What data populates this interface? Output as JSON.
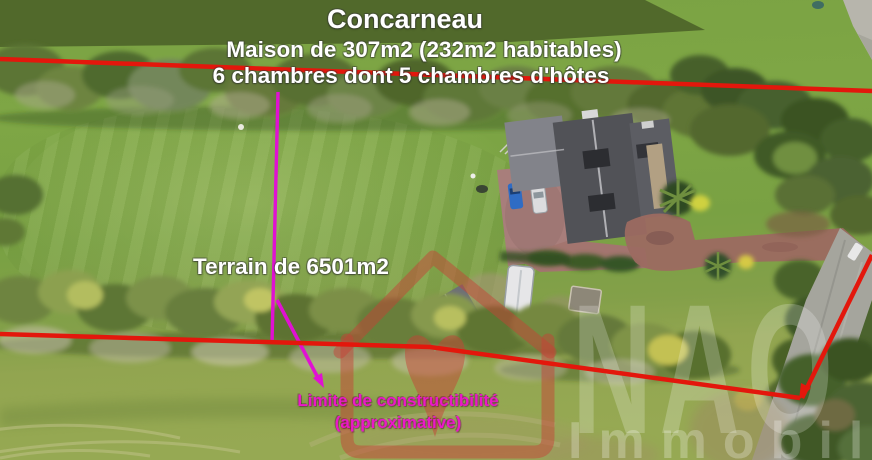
{
  "location": {
    "title": "Concarneau"
  },
  "property": {
    "line1": "Maison de 307m2 (232m2 habitables)",
    "line2": "6 chambres dont 5 chambres d'hôtes"
  },
  "terrain": {
    "label": "Terrain de 6501m2"
  },
  "limit": {
    "line1": "Limite de constructibilité",
    "line2": "(approximative)"
  },
  "watermark": {
    "brand": "NAO",
    "sub": "Immobilier"
  },
  "icons": {
    "logo": "house-heart-icon"
  },
  "colors": {
    "boundary": "#e3170c",
    "limit_line": "#e011d2",
    "limit_text": "#ea18c8",
    "overlay_text": "#ffffff",
    "watermark_red": "rgba(199,64,54,0.48)",
    "watermark_white": "rgba(255,255,255,0.22)",
    "watermark_white2": "rgba(255,255,255,0.26)"
  }
}
